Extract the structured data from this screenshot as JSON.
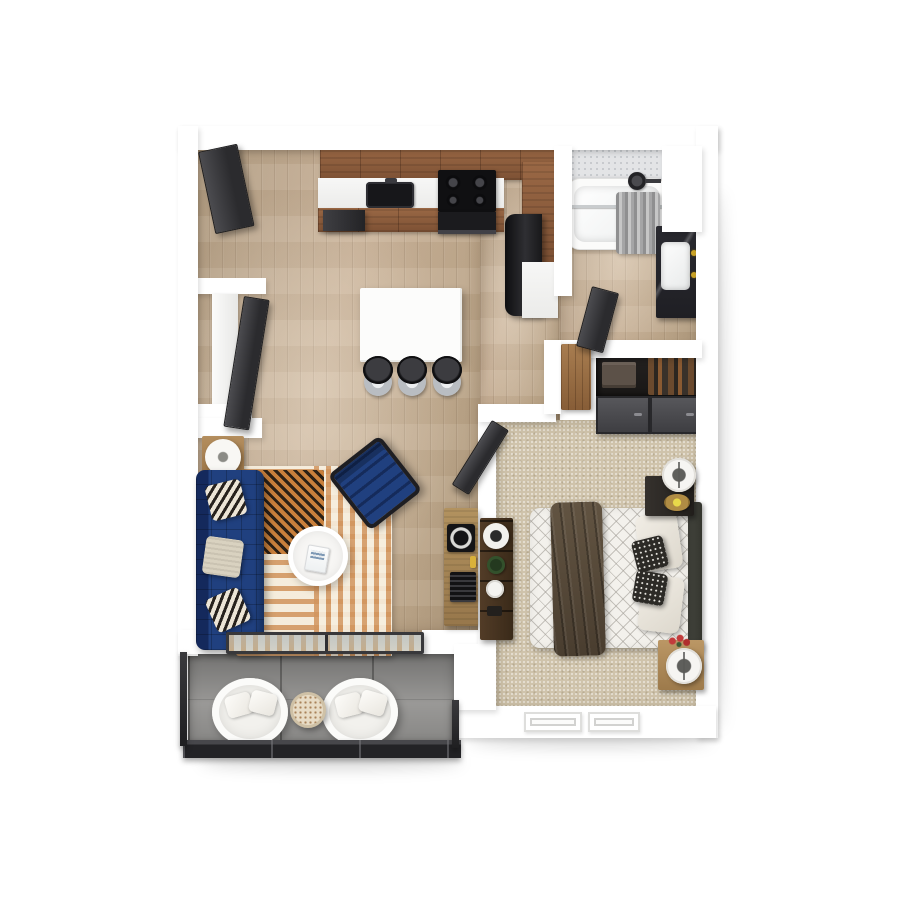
{
  "scene": {
    "type": "3d-floor-plan-render",
    "view": "top-down",
    "description": "Top-down 3D render of a one-bedroom, one-bath apartment with balcony"
  },
  "palette": {
    "background": "#ffffff",
    "wall": "#ffffff",
    "wood_floor": "#c0a98e",
    "carpet": "#cfc3ab",
    "balcony_floor": "#a3a2a0",
    "cabinet_wood": "#8f6041",
    "counter_white": "#f4f4f3",
    "appliance_black": "#1e1e20",
    "island_white": "#fcfcfb",
    "sofa_navy": "#1d3c78",
    "accent_chair_navy": "#1e3c7e",
    "rug_cream": "#ecdfc6",
    "rug_orange": "#d2955e",
    "rug_dark": "#2b2015",
    "console_wood": "#a8895f",
    "bed_linen": "#f3f1ec",
    "throw_brown": "#57493a",
    "headboard_gray": "#41423c",
    "nightstand_dark": "#2b2826",
    "nightstand_wood": "#b08c5c",
    "dresser_brown": "#453221",
    "door_dark": "#39393b",
    "tile_gray": "#e3e4e6",
    "vanity_dark": "#25252b",
    "curtain_gray": "#a8a8a8",
    "glass_blue": "rgba(168,181,189,0.6)",
    "railing_dark": "#2a2a2c",
    "brass_gold": "#c9a227",
    "flower_red": "#c23b3b"
  },
  "rooms": {
    "kitchen": {
      "label": "Kitchen",
      "floor": "hardwood"
    },
    "living_room": {
      "label": "Living Room",
      "floor": "hardwood"
    },
    "bathroom": {
      "label": "Bathroom",
      "floor": "hardwood"
    },
    "bedroom": {
      "label": "Bedroom",
      "floor": "carpet"
    },
    "hallway": {
      "label": "Hallway",
      "floor": "hardwood"
    },
    "balcony": {
      "label": "Balcony",
      "floor": "concrete"
    },
    "laundry_closet": {
      "label": "Laundry Closet"
    },
    "bedroom_closet": {
      "label": "Bedroom Closet"
    },
    "linen_closet": {
      "label": "Linen Closet"
    }
  },
  "furniture": {
    "entry_door": "Entry door (open)",
    "upper_cabinets": "Kitchen upper cabinets",
    "kitchen_counter": "Kitchen counter",
    "kitchen_sink": "Kitchen sink",
    "stove": "Range with four burners",
    "oven": "Oven",
    "dishwasher": "Dishwasher",
    "refrigerator": "Refrigerator",
    "island": "Kitchen island",
    "bar_stool": "Bar stool",
    "sofa": "Navy tufted sofa with throw pillows",
    "side_table": "Side table with drum lamp",
    "rug": "Striped area rug with zigzag corner",
    "coffee_table": "Round coffee table with magazine",
    "accent_chair": "Navy accent chair",
    "media_console": "Media console with record player and speaker",
    "bathtub": "Bathtub with shower head",
    "shower_curtain": "Shower curtain",
    "vanity": "Bathroom vanity with sink and brass faucet",
    "bathroom_door": "Bathroom door (open)",
    "laundry_door": "Laundry closet door (open)",
    "laundry_appliance": "Stacked laundry unit",
    "linen_door": "Linen closet door",
    "closet_shelf": "Closet shelf with folded and hanging clothes",
    "closet_doors": "Sliding closet doors",
    "bedroom_door": "Bedroom door (open)",
    "bed": "Bed with diamond-quilted duvet and brown throw",
    "headboard": "Headboard",
    "nightstand_upper": "Nightstand with ring lamp and candle tray",
    "nightstand_lower": "Wood nightstand with ring lamp and flowers",
    "dresser": "Dresser with speaker, plant and clock",
    "window": "Bedroom window",
    "sliding_glass_door": "Sliding glass door to balcony",
    "patio_chair": "Patio chair with cushions",
    "patio_table": "Round mosaic patio table",
    "railing": "Balcony railing"
  }
}
